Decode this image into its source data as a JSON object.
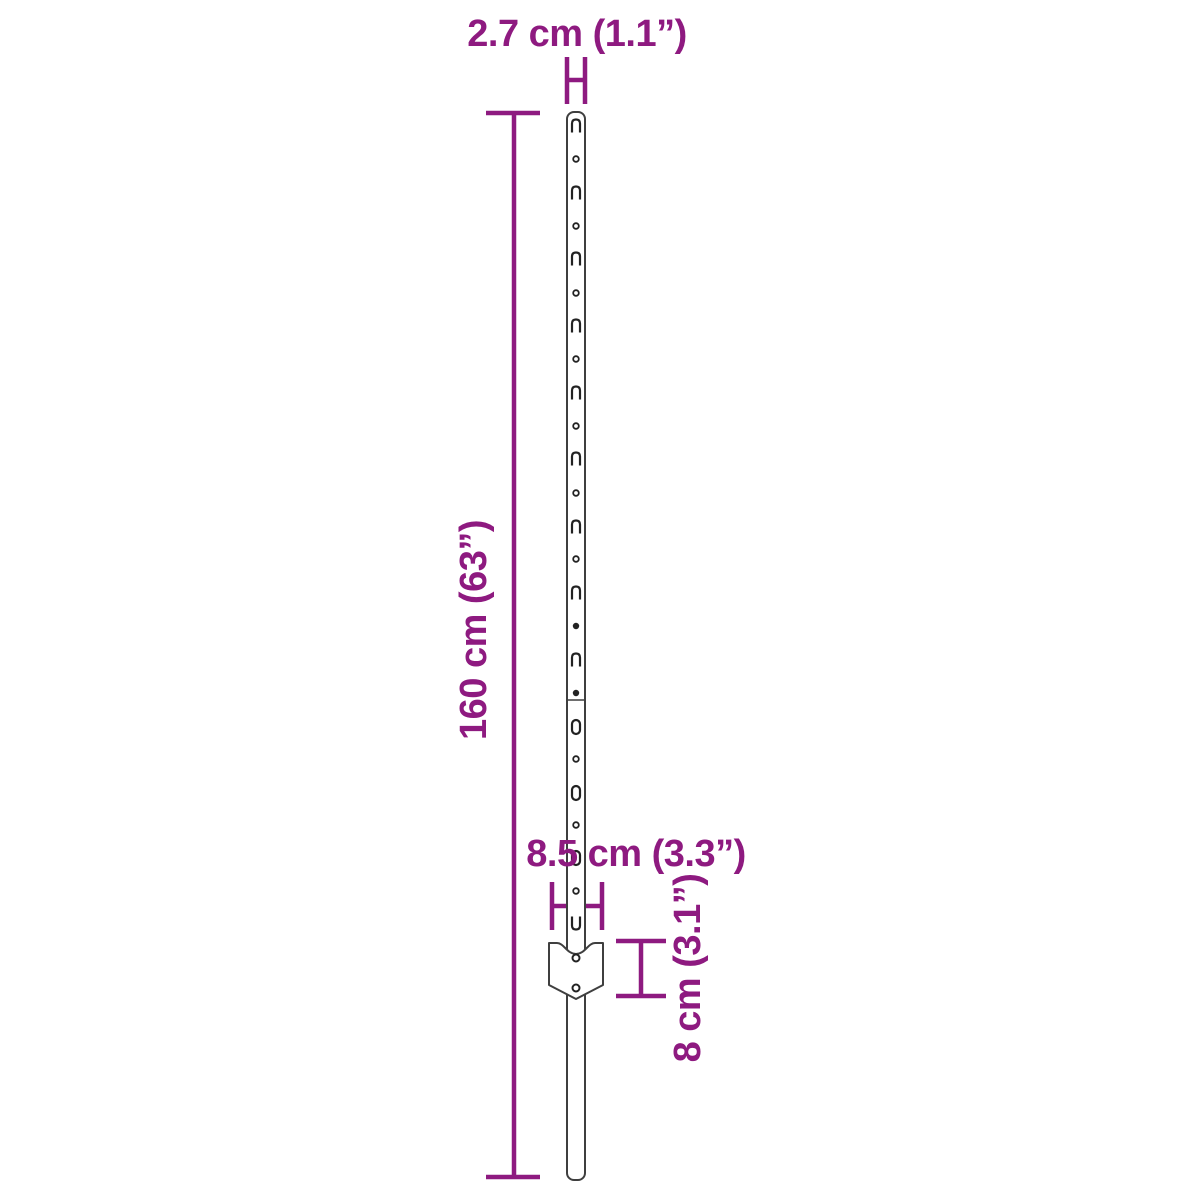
{
  "colors": {
    "accent": "#8E1A80",
    "outline": "#3F3F3F",
    "feature": "#222222"
  },
  "labels": {
    "post_width": "2.7 cm (1.1”)",
    "total_height": "160 cm (63”)",
    "plate_width": "8.5 cm (3.3”)",
    "plate_height": "8 cm (3.1”)"
  },
  "figure": {
    "description": "T-post garden stake with hook slots, holes, telescoping seam and anchor plate",
    "seam_y": 700,
    "features": [
      {
        "type": "slot_open_bottom",
        "y": 126
      },
      {
        "type": "hole",
        "y": 159
      },
      {
        "type": "slot_open_bottom",
        "y": 193
      },
      {
        "type": "hole",
        "y": 226
      },
      {
        "type": "slot_open_bottom",
        "y": 259
      },
      {
        "type": "hole",
        "y": 293
      },
      {
        "type": "slot_open_bottom",
        "y": 326
      },
      {
        "type": "hole",
        "y": 359
      },
      {
        "type": "slot_open_bottom",
        "y": 393
      },
      {
        "type": "hole",
        "y": 426
      },
      {
        "type": "slot_open_bottom",
        "y": 459
      },
      {
        "type": "hole",
        "y": 493
      },
      {
        "type": "slot_open_bottom",
        "y": 527
      },
      {
        "type": "hole",
        "y": 559
      },
      {
        "type": "slot_open_bottom",
        "y": 593
      },
      {
        "type": "hole_filled",
        "y": 626
      },
      {
        "type": "slot_open_bottom",
        "y": 660
      },
      {
        "type": "hole_filled",
        "y": 693
      },
      {
        "type": "slot_closed",
        "y": 727
      },
      {
        "type": "hole",
        "y": 759
      },
      {
        "type": "slot_closed",
        "y": 793
      },
      {
        "type": "hole",
        "y": 825
      },
      {
        "type": "slot_closed",
        "y": 858
      },
      {
        "type": "hole",
        "y": 891
      },
      {
        "type": "slot_open_top",
        "y": 923
      }
    ],
    "plate_hole_ys": [
      958,
      988
    ]
  }
}
